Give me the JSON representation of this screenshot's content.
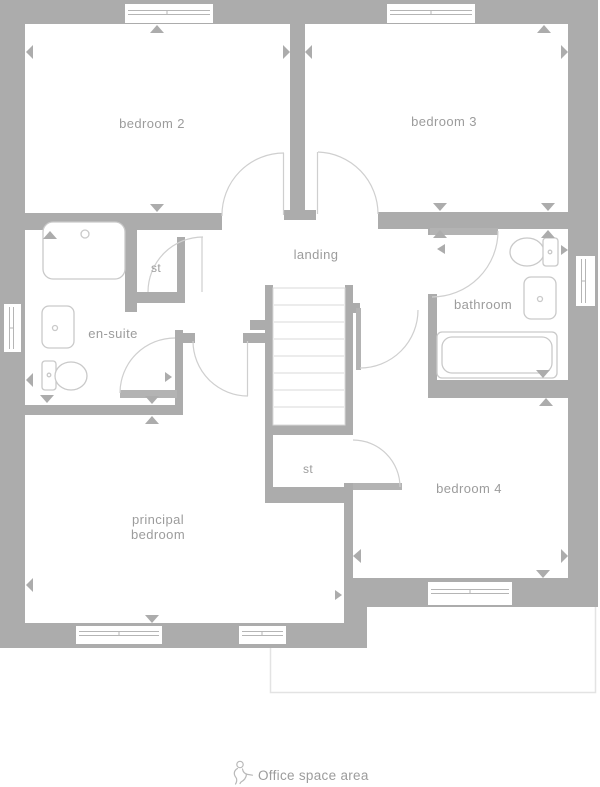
{
  "rooms": {
    "bedroom2": {
      "label": "bedroom 2"
    },
    "bedroom3": {
      "label": "bedroom 3"
    },
    "landing": {
      "label": "landing"
    },
    "storage_top": {
      "label": "st"
    },
    "ensuite": {
      "label": "en-suite"
    },
    "bathroom": {
      "label": "bathroom"
    },
    "storage_bottom": {
      "label": "st"
    },
    "principal_bedroom": {
      "label_line1": "principal",
      "label_line2": "bedroom"
    },
    "bedroom4": {
      "label": "bedroom 4"
    }
  },
  "footer": {
    "office_label": "Office space area",
    "icon": "person-seated-icon"
  },
  "colors": {
    "wall": "#acacac",
    "label": "#9c9c9c",
    "fixture": "#c9c9c9",
    "door": "#cfcfcf",
    "leaf": "#b3b3b3",
    "stair": "#d8d8d8",
    "window_line": "#b5b5b5",
    "office_outline": "#e3e3e3"
  }
}
